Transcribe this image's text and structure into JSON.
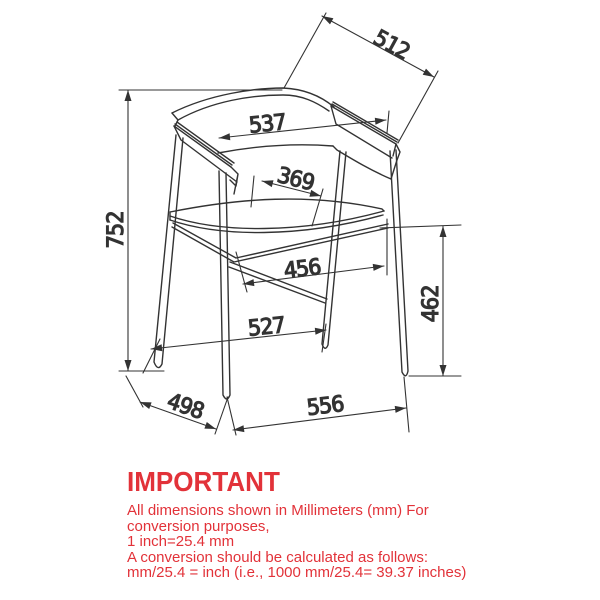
{
  "drawing": {
    "title": "chair-technical-drawing",
    "units": "mm",
    "line_color": "#333333",
    "dimensions": {
      "left_height": "752",
      "top_diagonal": "512",
      "back_width": "537",
      "seat_depth": "369",
      "inner_width": "456",
      "seat_height": "462",
      "floor_depth": "527",
      "front_depth": "498",
      "floor_width": "556"
    }
  },
  "notice": {
    "accent_color": "#e23239",
    "title": "IMPORTANT",
    "lines": [
      "All dimensions shown in Millimeters (mm) For",
      "conversion purposes,",
      "1 inch=25.4 mm",
      "A conversion should be calculated as follows:",
      "mm/25.4 = inch (i.e., 1000 mm/25.4= 39.37 inches)"
    ]
  }
}
